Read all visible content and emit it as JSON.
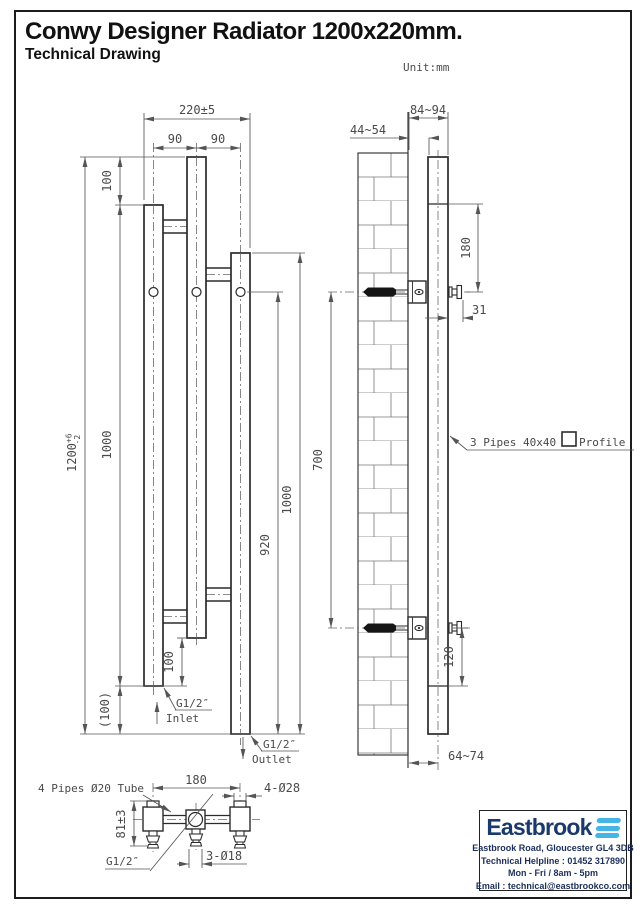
{
  "header": {
    "title": "Conwy Designer Radiator 1200x220mm.",
    "subtitle": "Technical Drawing",
    "unit": "Unit:mm"
  },
  "front": {
    "width": "220±5",
    "pitch_left": "90",
    "pitch_right": "90",
    "offset_top": "100",
    "height": "1200",
    "tol_plus": "+6",
    "tol_minus": "-2",
    "len_left_bar": "1000",
    "hole_height": "920",
    "len_right_bar": "1000",
    "offset_bottom": "100",
    "ref_bottom": "(100)",
    "inlet_thread": "G1/2″",
    "inlet_label": "Inlet",
    "outlet_thread": "G1/2″",
    "outlet_label": "Outlet"
  },
  "side": {
    "depth_outer": "84~94",
    "depth_inner": "44~54",
    "top_to_bracket": "180",
    "screw_projection": "31",
    "bracket_span": "700",
    "bracket_bottom": "120",
    "wall_to_center": "64~74",
    "note_prefix": "3 Pipes 40x40",
    "note_suffix": "Profile"
  },
  "bottom": {
    "pipes_label": "4 Pipes Ø20 Tube",
    "width": "180",
    "caps": "4-Ø28",
    "height": "81±3",
    "thread": "G1/2″",
    "holes": "3-Ø18"
  },
  "footer": {
    "brand": "Eastbrook",
    "address": "Eastbrook Road, Gloucester GL4 3DB",
    "helpline": "Technical Helpline : 01452 317890",
    "hours": "Mon - Fri / 8am - 5pm",
    "email": "Email : technical@eastbrookco.com",
    "brand_color": "#1b3a6c",
    "accent_color": "#45b5e6"
  }
}
